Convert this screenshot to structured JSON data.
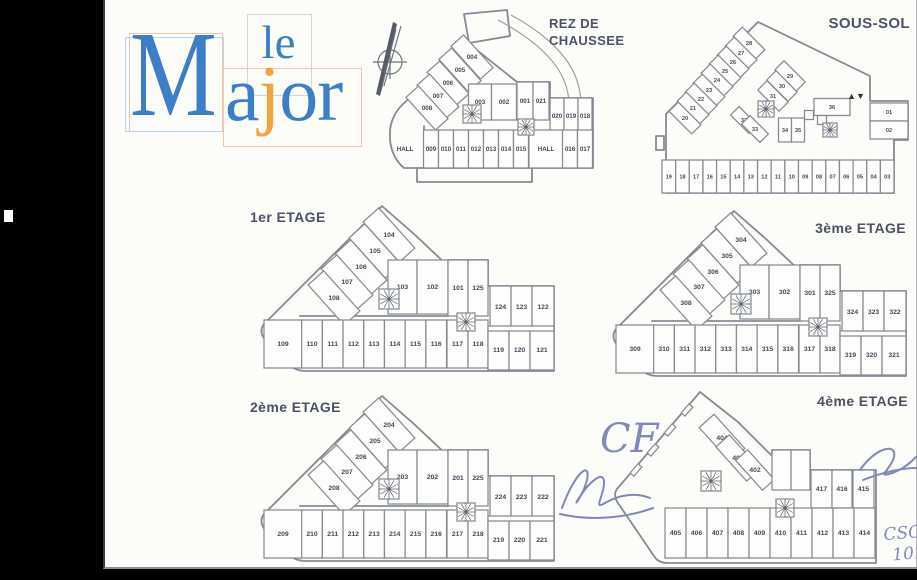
{
  "logo": {
    "le": "le",
    "m": "M",
    "a": "a",
    "j": "j",
    "or": "or"
  },
  "plans": {
    "rez": {
      "title": [
        "REZ DE",
        "CHAUSSEE"
      ],
      "halls": [
        "HALL",
        "HALL"
      ],
      "groups": {
        "diagonal": [
          "004",
          "005",
          "006",
          "007",
          "008"
        ],
        "mid": [
          "003",
          "002"
        ],
        "inner": [
          "001",
          "021"
        ],
        "right": [
          "020",
          "019",
          "018"
        ],
        "bottom": [
          "009",
          "010",
          "011",
          "012",
          "013",
          "014",
          "015"
        ],
        "bottom_right": [
          "016",
          "017"
        ]
      }
    },
    "sous": {
      "title": [
        "SOUS-SOL"
      ],
      "lift_symbol": "▲▼",
      "groups": {
        "diagonal": [
          "28",
          "27",
          "26",
          "25",
          "24",
          "23",
          "22",
          "21",
          "20"
        ],
        "diag2": [
          "29",
          "30",
          "31"
        ],
        "diag3": [
          "32",
          "33"
        ],
        "small": [
          "34",
          "35"
        ],
        "big": [
          "36"
        ],
        "right": [
          "01",
          "02"
        ],
        "bottom": [
          "19",
          "18",
          "17",
          "16",
          "15",
          "14",
          "13",
          "12",
          "11",
          "10",
          "09",
          "08",
          "07",
          "06",
          "05",
          "04",
          "03"
        ]
      }
    },
    "e1": {
      "title": [
        "1er ETAGE"
      ],
      "groups": {
        "diagonal": [
          "104",
          "105",
          "106",
          "107",
          "108"
        ],
        "mid": [
          "103",
          "102"
        ],
        "inner": [
          "101",
          "125"
        ],
        "trio": [
          "124",
          "123",
          "122"
        ],
        "bottom": [
          "109",
          "110",
          "111",
          "112",
          "113",
          "114",
          "115",
          "116",
          "117",
          "118",
          "119",
          "120",
          "121"
        ]
      }
    },
    "e2": {
      "title": [
        "2ème ETAGE"
      ],
      "groups": {
        "diagonal": [
          "204",
          "205",
          "206",
          "207",
          "208"
        ],
        "mid": [
          "203",
          "202"
        ],
        "inner": [
          "201",
          "225"
        ],
        "trio": [
          "224",
          "223",
          "222"
        ],
        "bottom": [
          "209",
          "210",
          "211",
          "212",
          "213",
          "214",
          "215",
          "216",
          "217",
          "218",
          "219",
          "220",
          "221"
        ]
      }
    },
    "e3": {
      "title": [
        "3ème ETAGE"
      ],
      "groups": {
        "diagonal": [
          "304",
          "305",
          "306",
          "307",
          "308"
        ],
        "mid": [
          "303",
          "302"
        ],
        "inner": [
          "301",
          "325"
        ],
        "trio": [
          "324",
          "323",
          "322"
        ],
        "bottom": [
          "309",
          "310",
          "311",
          "312",
          "313",
          "314",
          "315",
          "316",
          "317",
          "318",
          "319",
          "320",
          "321"
        ]
      }
    },
    "e4": {
      "title": [
        "4ème ETAGE"
      ],
      "groups": {
        "diagonal": [
          "404",
          "403",
          "402"
        ],
        "trio": [
          "417",
          "416",
          "415"
        ],
        "bottom": [
          "405",
          "406",
          "407",
          "408",
          "409",
          "410",
          "411",
          "412",
          "413",
          "414"
        ]
      }
    }
  },
  "annotations": {
    "initials": "CF",
    "note_line1": "CSC",
    "note_line2": "101"
  },
  "colors": {
    "logo_blue": "#3e7ec6",
    "logo_orange": "#f0a63c",
    "plan_line": "#858b95",
    "room_text": "#414859",
    "title_text": "#4b5264",
    "ink": "#8089ba"
  }
}
